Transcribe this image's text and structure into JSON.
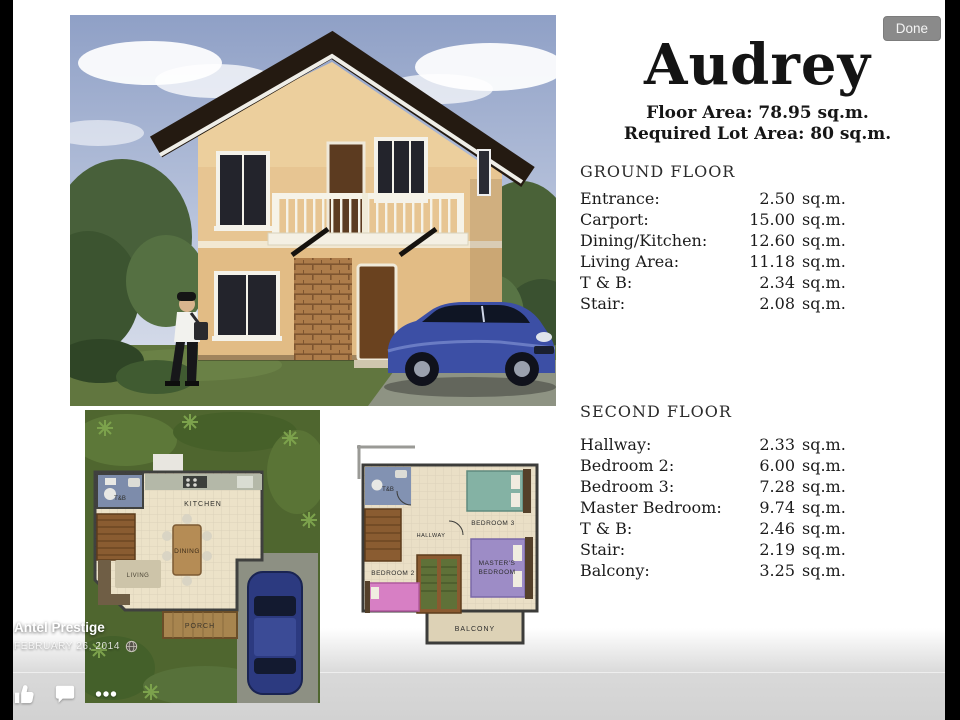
{
  "viewer": {
    "done_label": "Done",
    "author": "Antel Prestige",
    "date": "FEBRUARY 26, 2014",
    "icons": {
      "like": "thumbs-up",
      "comment": "speech-bubble",
      "more": "ellipsis",
      "privacy": "globe"
    },
    "colors": {
      "done_bg": "#8a8a8a",
      "overlay_text": "#ffffff",
      "page_fade": "#d2d2d2"
    }
  },
  "flyer": {
    "title": "Audrey",
    "floor_area_label": "Floor Area: 78.95 sq.m.",
    "lot_area_label": "Required Lot Area: 80 sq.m.",
    "ground_floor": {
      "heading": "GROUND FLOOR",
      "rows": [
        {
          "label": "Entrance:",
          "value": "2.50",
          "unit": "sq.m."
        },
        {
          "label": "Carport:",
          "value": "15.00",
          "unit": "sq.m."
        },
        {
          "label": "Dining/Kitchen:",
          "value": "12.60",
          "unit": "sq.m."
        },
        {
          "label": "Living Area:",
          "value": "11.18",
          "unit": "sq.m."
        },
        {
          "label": "T & B:",
          "value": "2.34",
          "unit": "sq.m."
        },
        {
          "label": "Stair:",
          "value": "2.08",
          "unit": "sq.m."
        }
      ]
    },
    "second_floor": {
      "heading": "SECOND FLOOR",
      "rows": [
        {
          "label": "Hallway:",
          "value": "2.33",
          "unit": "sq.m."
        },
        {
          "label": "Bedroom 2:",
          "value": "6.00",
          "unit": "sq.m."
        },
        {
          "label": "Bedroom 3:",
          "value": "7.28",
          "unit": "sq.m."
        },
        {
          "label": "Master Bedroom:",
          "value": "9.74",
          "unit": "sq.m."
        },
        {
          "label": "T & B:",
          "value": "2.46",
          "unit": "sq.m."
        },
        {
          "label": "Stair:",
          "value": "2.19",
          "unit": "sq.m."
        },
        {
          "label": "Balcony:",
          "value": "3.25",
          "unit": "sq.m."
        }
      ]
    },
    "ground_plan_labels": {
      "tb": "T&B",
      "kitchen": "KITCHEN",
      "dining": "DINING",
      "living": "LIVING",
      "porch": "PORCH"
    },
    "second_plan_labels": {
      "tb": "T&B",
      "hallway": "HALLWAY",
      "bedroom3": "BEDROOM 3",
      "bedroom2": "BEDROOM 2",
      "master_line1": "MASTER'S",
      "master_line2": "BEDROOM",
      "balcony": "BALCONY"
    }
  }
}
